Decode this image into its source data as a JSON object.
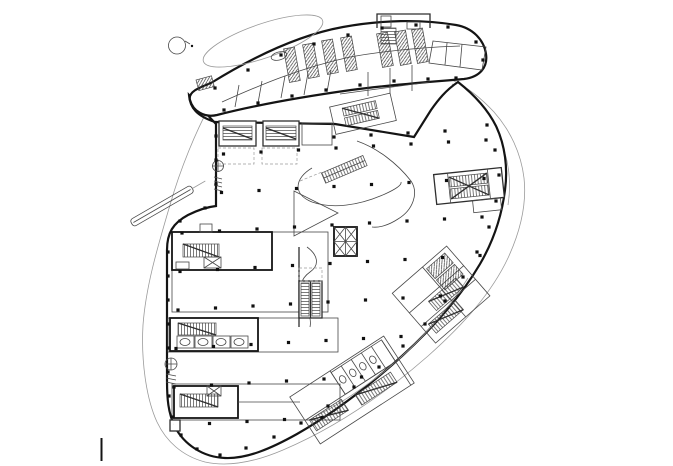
{
  "document": {
    "kind": "architectural floor plan drawing",
    "description": "Black-and-white CAD floor plan of a free-form bean-shaped building: rotated capsule upper wing with hatched skylight strips, open floor with column grid, stair and elevator cores, escalators, atrium void curves, thin site/overhang boundary lines",
    "background": "#ffffff"
  },
  "colors": {
    "heavy_line": "#141414",
    "medium_line": "#2e2e2e",
    "thin_line": "#474747",
    "light_line": "#9a9a9a",
    "hatch_line": "#333333",
    "column_dot": "#101010"
  },
  "column_grid": {
    "origin": [
      186,
      156
    ],
    "u": [
      37.5,
      -2
    ],
    "v": [
      -2,
      38.5
    ],
    "cols": 9,
    "rows": 8,
    "size": 3.2
  },
  "extra_columns": [
    [
      487,
      125
    ],
    [
      495,
      150
    ],
    [
      499,
      175
    ],
    [
      496,
      201
    ],
    [
      489,
      227
    ],
    [
      477,
      252
    ],
    [
      463,
      277
    ],
    [
      445,
      301
    ],
    [
      425,
      324
    ],
    [
      403,
      346
    ],
    [
      379,
      367
    ],
    [
      354,
      387
    ],
    [
      328,
      406
    ],
    [
      301,
      423
    ],
    [
      274,
      437
    ],
    [
      246,
      448
    ],
    [
      220,
      455
    ],
    [
      197,
      449
    ],
    [
      181,
      435
    ],
    [
      172,
      417
    ],
    [
      169,
      396
    ],
    [
      168,
      372
    ],
    [
      168,
      348
    ],
    [
      168,
      324
    ],
    [
      168,
      300
    ],
    [
      168,
      276
    ],
    [
      168,
      252
    ],
    [
      180,
      221
    ],
    [
      205,
      208
    ],
    [
      216,
      184
    ],
    [
      216,
      160
    ],
    [
      216,
      136
    ],
    [
      215,
      88
    ],
    [
      248,
      70
    ],
    [
      281,
      55
    ],
    [
      314,
      44
    ],
    [
      348,
      35
    ],
    [
      382,
      28
    ],
    [
      416,
      25
    ],
    [
      448,
      27
    ],
    [
      476,
      42
    ],
    [
      483,
      60
    ],
    [
      224,
      110
    ],
    [
      258,
      103
    ],
    [
      292,
      96
    ],
    [
      326,
      90
    ],
    [
      360,
      85
    ],
    [
      394,
      81
    ],
    [
      428,
      79
    ],
    [
      456,
      78
    ],
    [
      334,
      137
    ],
    [
      371,
      135
    ],
    [
      408,
      133
    ],
    [
      445,
      131
    ]
  ],
  "skylights": {
    "angle": -10,
    "width": 11,
    "length": 34,
    "tops": [
      [
        289,
        48
      ],
      [
        308,
        44
      ],
      [
        327,
        40
      ],
      [
        346,
        37
      ],
      [
        382,
        33
      ],
      [
        400,
        31
      ],
      [
        417,
        29
      ]
    ]
  },
  "features": [
    "site-boundary",
    "overhang-ellipse-outline",
    "upper-wing",
    "main-floor",
    "skylight-strips",
    "roof-access-box",
    "column-grid",
    "top-band-stair-cores",
    "wedge-stair-core",
    "right-stair-core",
    "central-elevator-core",
    "left-center-core",
    "left-lower-core",
    "bottom-left-core",
    "escalator-bank",
    "atrium-void",
    "bottom-diagonal-rooms",
    "right-diagonal-rooms",
    "ramp-canopy",
    "entry-circle-symbol",
    "scale-tick"
  ]
}
